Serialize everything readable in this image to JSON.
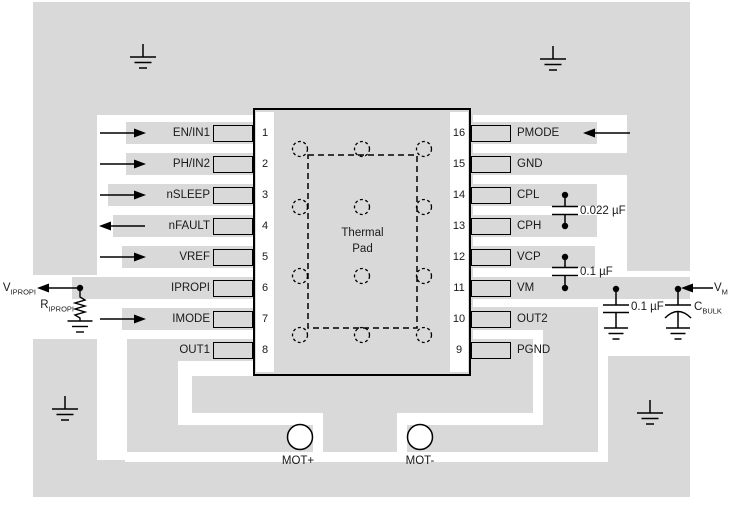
{
  "diagram_title": "IC PCB layout example",
  "colors": {
    "copper": "#d9d9d9",
    "board": "#ffffff",
    "line": "#000000",
    "text": "#1a1a1a"
  },
  "ic": {
    "thermal_pad_line1": "Thermal",
    "thermal_pad_line2": "Pad",
    "via_count": 12
  },
  "pins": {
    "left": [
      {
        "number": "1",
        "label": "EN/IN1",
        "direction": "input"
      },
      {
        "number": "2",
        "label": "PH/IN2",
        "direction": "input"
      },
      {
        "number": "3",
        "label": "nSLEEP",
        "direction": "input"
      },
      {
        "number": "4",
        "label": "nFAULT",
        "direction": "output"
      },
      {
        "number": "5",
        "label": "VREF",
        "direction": "input"
      },
      {
        "number": "6",
        "label": "IPROPI",
        "direction": "output"
      },
      {
        "number": "7",
        "label": "IMODE",
        "direction": "input"
      },
      {
        "number": "8",
        "label": "OUT1",
        "direction": "none"
      }
    ],
    "right": [
      {
        "number": "16",
        "label": "PMODE",
        "direction": "input"
      },
      {
        "number": "15",
        "label": "GND",
        "direction": "none"
      },
      {
        "number": "14",
        "label": "CPL",
        "direction": "none"
      },
      {
        "number": "13",
        "label": "CPH",
        "direction": "none"
      },
      {
        "number": "12",
        "label": "VCP",
        "direction": "none"
      },
      {
        "number": "11",
        "label": "VM",
        "direction": "input"
      },
      {
        "number": "10",
        "label": "OUT2",
        "direction": "none"
      },
      {
        "number": "9",
        "label": "PGND",
        "direction": "none"
      }
    ]
  },
  "components": {
    "cap_cp_value": "0.022 µF",
    "cap_vcp_value": "0.1 µF",
    "cap_vm_value": "0.1 µF",
    "c_bulk": {
      "main": "C",
      "sub": "BULK"
    },
    "v_m": {
      "main": "V",
      "sub": "M"
    },
    "v_ipropi": {
      "main": "V",
      "sub": "IPROPI"
    },
    "r_ipropi": {
      "main": "R",
      "sub": "IPROPI"
    }
  },
  "pads": {
    "mot_plus": "MOT+",
    "mot_minus": "MOT-"
  }
}
